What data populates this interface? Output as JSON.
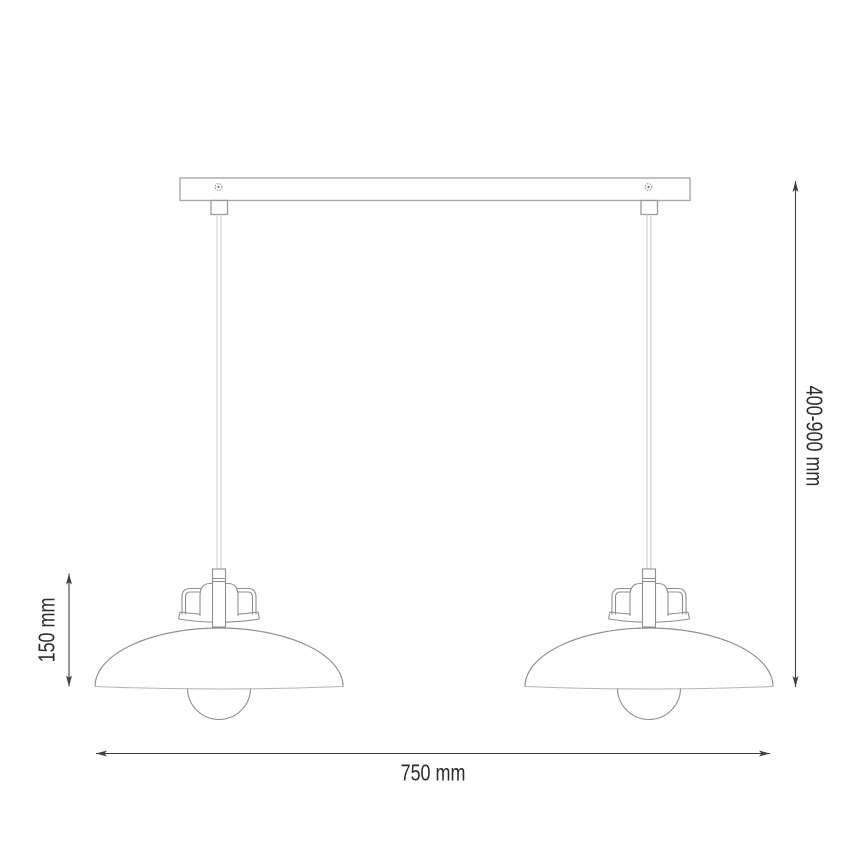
{
  "diagram": {
    "title": "double pendant lamp dimension drawing",
    "type": "technical-dimension-diagram",
    "dimensions": {
      "width": {
        "label": "750 mm",
        "meaning": "overall fixture width"
      },
      "drop": {
        "label": "400-900 mm",
        "meaning": "adjustable suspension height"
      },
      "shade": {
        "label": "150 mm",
        "meaning": "lamp head height"
      }
    },
    "colors": {
      "background": "#ffffff",
      "outline_light": "#adadad",
      "outline_mid": "#8f8f8f",
      "rim_light": "#b5b5b5",
      "cord": "#cfcfcf",
      "dimension_line": "#3f3f3f",
      "label_text": "#2b2b2b"
    }
  }
}
